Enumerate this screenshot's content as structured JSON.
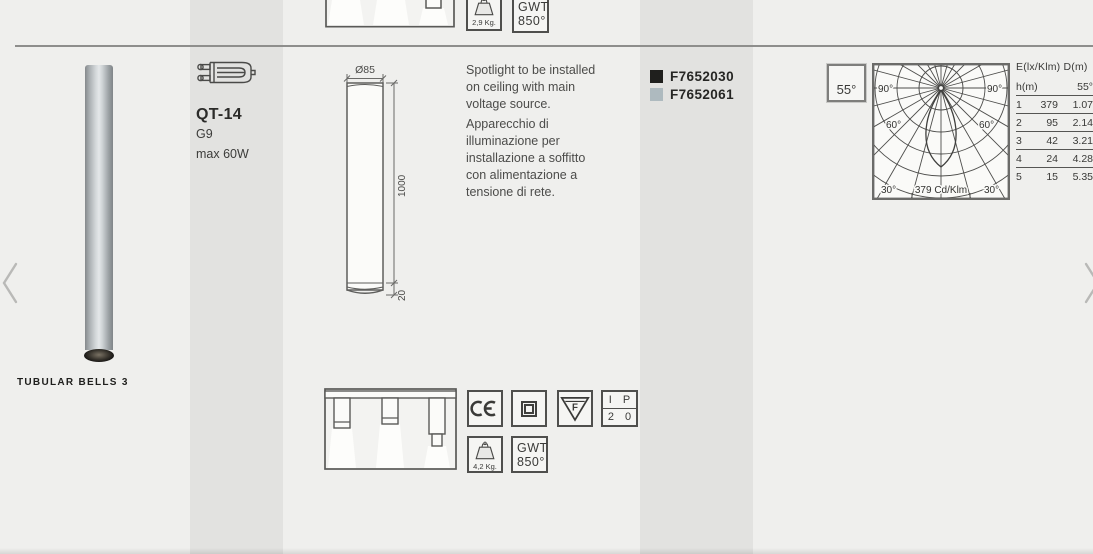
{
  "product": {
    "name": "TUBULAR BELLS 3",
    "lamp": {
      "type": "QT-14",
      "socket": "G9",
      "max_power": "max 60W"
    },
    "description_en": "Spotlight to be installed\non ceiling with main\nvoltage source.",
    "description_it": "Apparecchio di\nilluminazione per\ninstallazione a soffitto\ncon alimentazione a\ntensione di rete.",
    "codes": [
      {
        "code": "F7652030",
        "swatch": "#1f1f1d"
      },
      {
        "code": "F7652061",
        "swatch": "#aebabf"
      }
    ],
    "dimensions": {
      "diameter": "Ø85",
      "height": "1000",
      "base": "20"
    },
    "beam_angle": "55°",
    "weight": "4,2 Kg.",
    "glow_wire": {
      "line1": "GWT",
      "line2": "850°"
    },
    "ip_rating": {
      "line1": "I P",
      "line2": "2 0"
    },
    "f_mark": "F"
  },
  "previous_product": {
    "weight": "2,9 Kg.",
    "glow_wire": {
      "line1": "GWT",
      "line2": "850°"
    }
  },
  "photometry": {
    "cd_label": "379 Cd/Klm",
    "angles": {
      "l90": "90°",
      "r90": "90°",
      "l60": "60°",
      "r60": "60°",
      "l30": "30°",
      "r30": "30°"
    },
    "table": {
      "header": "E(lx/Klm) D(m)",
      "col_h": "h(m)",
      "col_angle": "55°",
      "rows": [
        [
          "1",
          "379",
          "1.07"
        ],
        [
          "2",
          "95",
          "2.14"
        ],
        [
          "3",
          "42",
          "3.21"
        ],
        [
          "4",
          "24",
          "4.28"
        ],
        [
          "5",
          "15",
          "5.35"
        ]
      ]
    }
  },
  "colors": {
    "accent_dark": "#1f1f1d",
    "accent_grey": "#aebabf",
    "page_bg": "#efefed"
  }
}
